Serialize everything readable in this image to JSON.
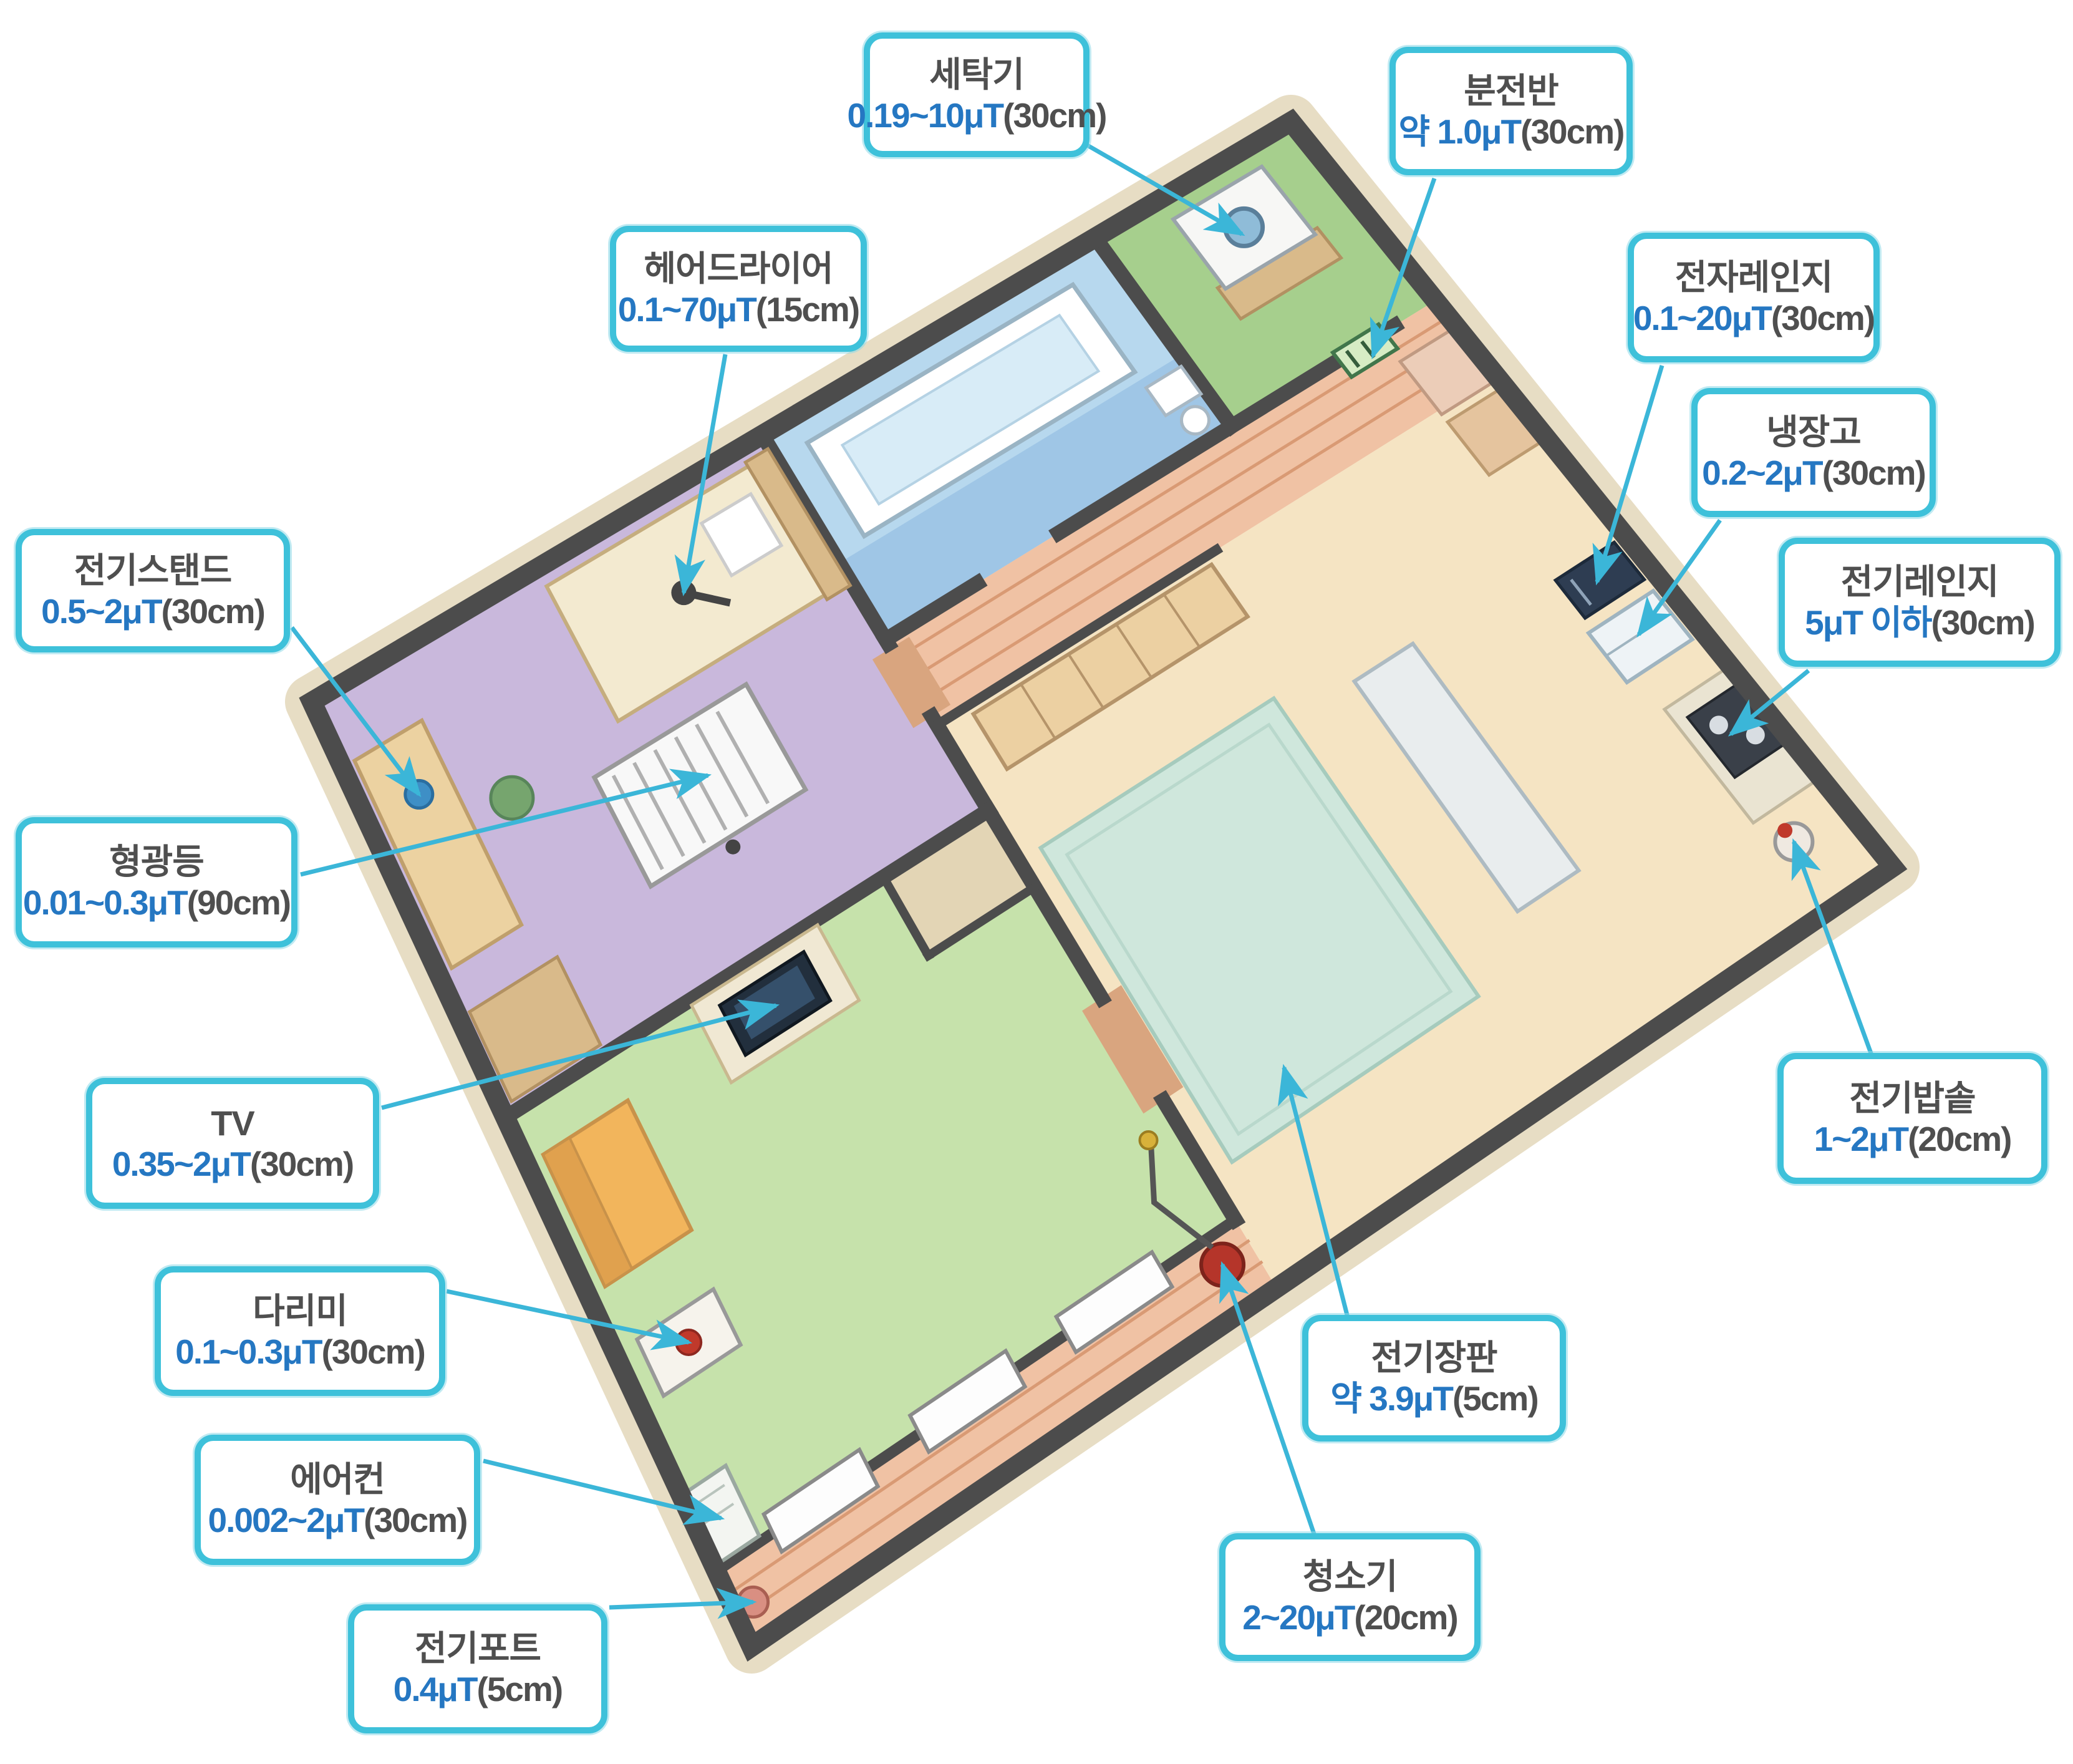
{
  "colors": {
    "accent_border": "#3ec1da",
    "value_text": "#2577c2",
    "title_text": "#4f4f4f",
    "arrow": "#3bb6d8",
    "wall": "#4c4c4c"
  },
  "callouts": {
    "washer": {
      "title": "세탁기",
      "value": "0.19~10μT",
      "suffix": "(30cm)"
    },
    "panel": {
      "title": "분전반",
      "value": "약 1.0μT",
      "suffix": "(30cm)"
    },
    "hair_dryer": {
      "title": "헤어드라이어",
      "value": "0.1~70μT",
      "suffix": "(15cm)"
    },
    "microwave": {
      "title": "전자레인지",
      "value": "0.1~20μT",
      "suffix": "(30cm)"
    },
    "refrigerator": {
      "title": "냉장고",
      "value": "0.2~2μT",
      "suffix": "(30cm)"
    },
    "electric_range": {
      "title": "전기레인지",
      "value": "5μT 이하",
      "suffix": "(30cm)"
    },
    "desk_lamp": {
      "title": "전기스탠드",
      "value": "0.5~2μT",
      "suffix": "(30cm)"
    },
    "fluorescent": {
      "title": "형광등",
      "value": "0.01~0.3μT",
      "suffix": "(90cm)"
    },
    "tv": {
      "title": "TV",
      "value": "0.35~2μT",
      "suffix": "(30cm)"
    },
    "iron": {
      "title": "다리미",
      "value": "0.1~0.3μT",
      "suffix": "(30cm)"
    },
    "air_conditioner": {
      "title": "에어컨",
      "value": "0.002~2μT",
      "suffix": "(30cm)"
    },
    "kettle": {
      "title": "전기포트",
      "value": "0.4μT",
      "suffix": "(5cm)"
    },
    "rice_cooker": {
      "title": "전기밥솥",
      "value": "1~2μT",
      "suffix": "(20cm)"
    },
    "electric_mat": {
      "title": "전기장판",
      "value": "약 3.9μT",
      "suffix": "(5cm)"
    },
    "vacuum": {
      "title": "청소기",
      "value": "2~20μT",
      "suffix": "(20cm)"
    }
  }
}
